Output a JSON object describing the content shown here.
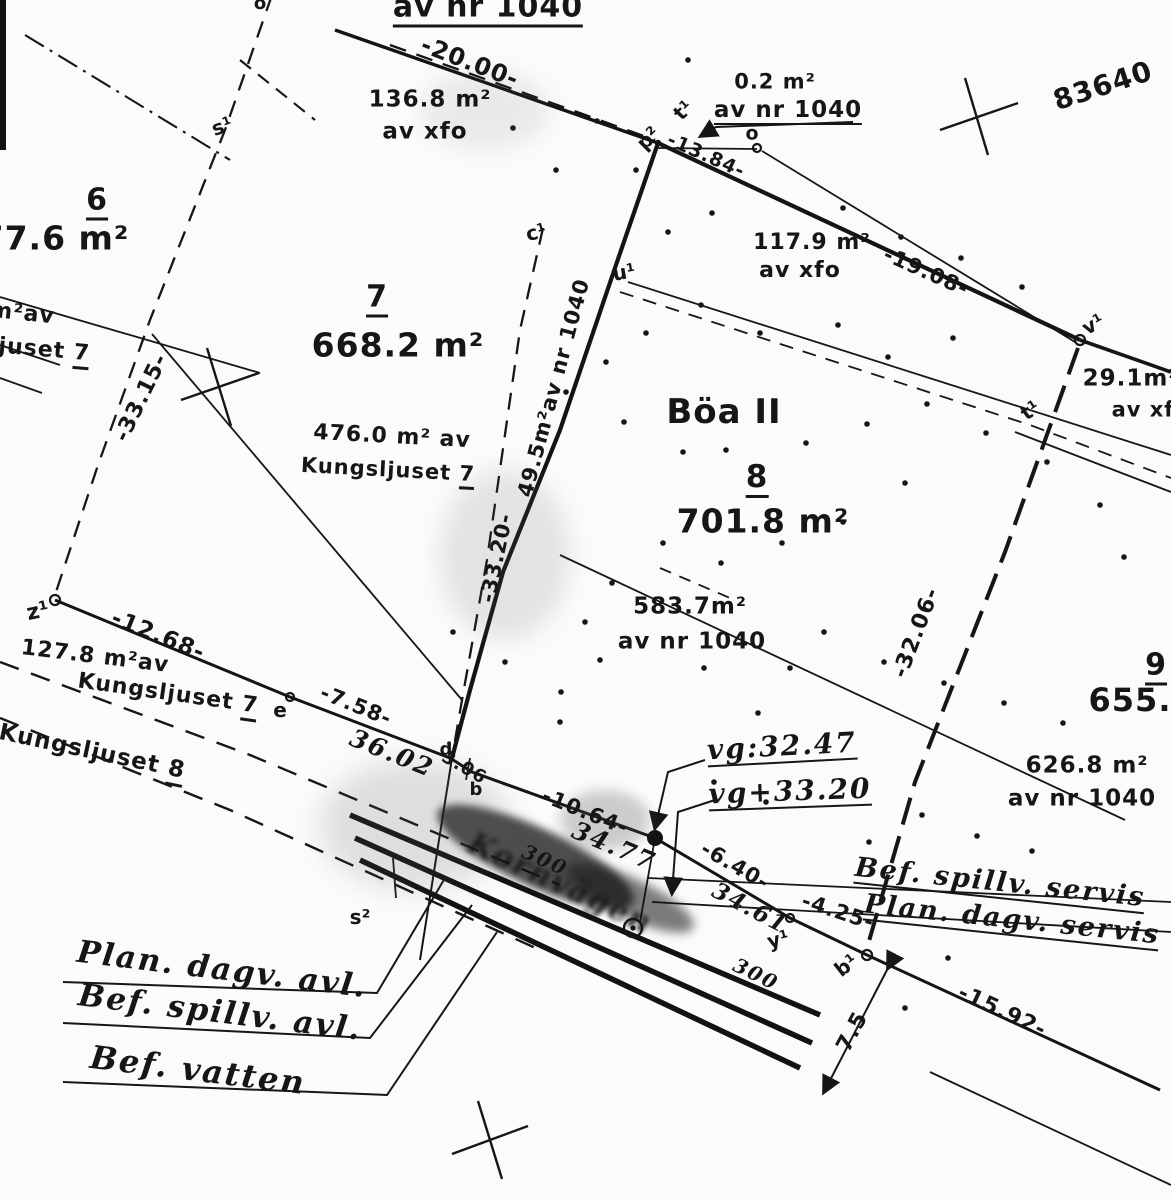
{
  "sheet": {
    "number": "83640",
    "district": "Böa II",
    "road": "Kornvägen"
  },
  "parcels": {
    "p6": {
      "id": "6",
      "area": "77.6 m²"
    },
    "p7": {
      "id": "7",
      "area": "668.2 m²"
    },
    "p8": {
      "id": "8",
      "area": "701.8 m²"
    },
    "p9": {
      "id": "9",
      "area": "655."
    }
  },
  "areas": {
    "top_of": "av nr 1040",
    "a02": "0.2 m²",
    "a02_of": "av nr 1040",
    "a1368": "136.8 m²",
    "a1368_of": "av xfo",
    "a1179": "117.9 m²",
    "a1179_of": "av xfo",
    "a291": "29.1m²",
    "a291_of": "av xf",
    "a4760": "476.0 m² av",
    "a495": "49.5m²av nr 1040",
    "a5837": "583.7m²",
    "a5837_of": "av nr 1040",
    "a1278": "127.8 m²av",
    "a6268": "626.8 m²",
    "a6268_of": "av nr 1040",
    "edge_cut_m2": "m²av",
    "edge_cut_name": "ljuset",
    "edge_cut_nr": "7",
    "kungsljuset": "Kungsljuset",
    "nr7": "7",
    "nr8": "8"
  },
  "dims": {
    "d2000": "-20.00-",
    "d1384": "-13.84-",
    "d1908": "-19.08-",
    "d3315": "-33.15-",
    "d3320": "-33.20-",
    "d3206": "-32.06-",
    "d1268": "-12.68-",
    "d758": "-7.58-",
    "d306": "3.06",
    "d1064": "-10.64-",
    "d640": "-6.40-",
    "d425": "-4.25-",
    "d1592": "-15.92-",
    "d75": "7.5"
  },
  "hand": {
    "m3602": "36.02",
    "m3477": "34.77",
    "m3461": "34.61",
    "p300a": "300",
    "p300b": "300",
    "vg1": "vg:32.47",
    "vg2": "vg+33.20",
    "servis1": "Bef. spillv. servis",
    "servis2": "Plan. dagv. servis",
    "legend1": "Plan. dagv. avl.",
    "legend2": "Bef. spillv. avl.",
    "legend3": "Bef. vatten"
  },
  "points": {
    "s1": "s¹",
    "otop": "ö",
    "c1": "c¹",
    "u1": "u¹",
    "p2": "p²",
    "t1a": "t¹",
    "o": "o",
    "v1": "v¹",
    "t1b": "t¹",
    "z1": "z¹",
    "e": "e",
    "d": "d",
    "b": "b",
    "s2": "s²",
    "y1": "y¹",
    "b1": "b¹"
  }
}
